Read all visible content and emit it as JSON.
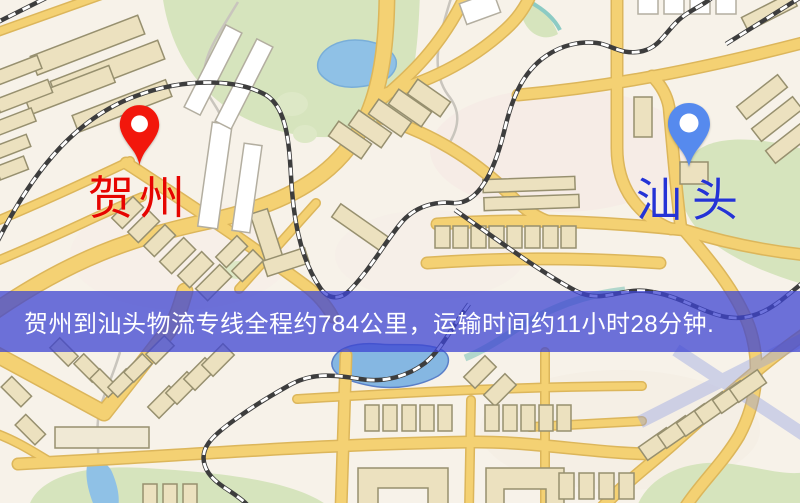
{
  "map": {
    "origin": {
      "label": "贺州",
      "label_color": "#e60400",
      "pin_color": "#f2170c"
    },
    "destination": {
      "label": "汕头",
      "label_color": "#2433d6",
      "pin_color": "#568aee"
    },
    "palette": {
      "background": "#f7f2e9",
      "road_fill": "#f4d173",
      "road_casing": "#dcb65b",
      "park_green": "#d6e4bd",
      "water_blue": "#8fc1e6",
      "building_fill": "#ece1bf",
      "building_outline": "#97906f",
      "railway_dark": "#3d3d3d"
    }
  },
  "banner": {
    "text": "贺州到汕头物流专线全程约784公里，运输时间约11小时28分钟.",
    "background": "rgba(62,68,210,0.75)",
    "text_color": "#ffffff"
  }
}
